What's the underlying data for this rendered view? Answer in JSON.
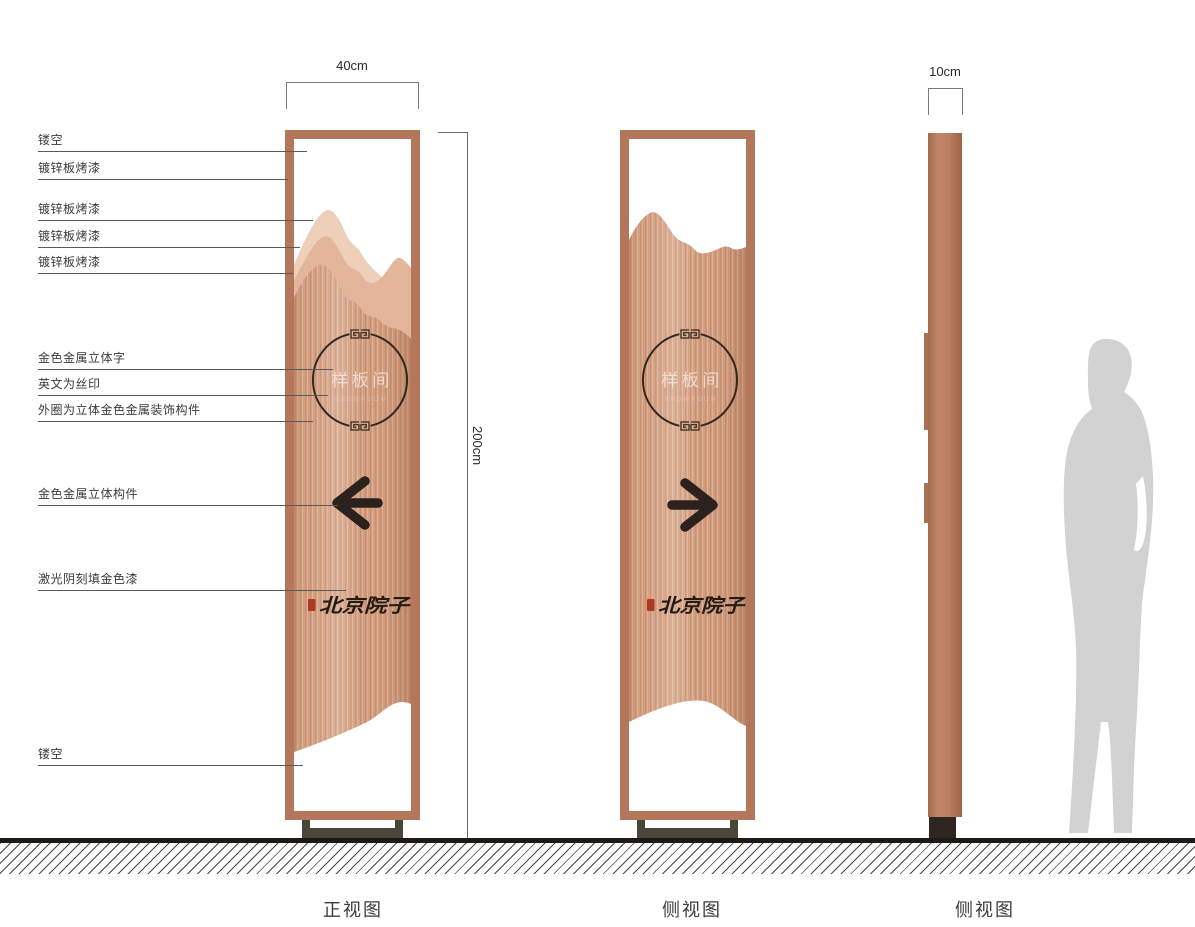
{
  "dimensions": {
    "front_width": "40cm",
    "height": "200cm",
    "side_thickness": "10cm"
  },
  "callouts": [
    {
      "id": "hollow-top",
      "label": "镂空"
    },
    {
      "id": "galvanized-frame",
      "label": "镀锌板烤漆"
    },
    {
      "id": "galvanized-layer-1",
      "label": "镀锌板烤漆"
    },
    {
      "id": "galvanized-layer-2",
      "label": "镀锌板烤漆"
    },
    {
      "id": "galvanized-layer-3",
      "label": "镀锌板烤漆"
    },
    {
      "id": "gold-metal-3d-text",
      "label": "金色金属立体字"
    },
    {
      "id": "english-silkscreen",
      "label": "英文为丝印"
    },
    {
      "id": "outer-ring-gold-ornament",
      "label": "外圈为立体金色金属装饰构件"
    },
    {
      "id": "gold-metal-3d-component",
      "label": "金色金属立体构件"
    },
    {
      "id": "laser-engraved-gold",
      "label": "激光阴刻填金色漆"
    },
    {
      "id": "hollow-bottom",
      "label": "镂空"
    }
  ],
  "sign_content": {
    "room_name": "样板间",
    "english_subtext": "SHOWROOM",
    "brand_name": "北京院子"
  },
  "views": [
    {
      "label": "正视图"
    },
    {
      "label": "侧视图"
    },
    {
      "label": "侧视图"
    }
  ],
  "colors": {
    "frame_copper": "#b5775c",
    "panel_copper": "#d49d7f",
    "mountain_light": "#eed0ba",
    "mountain_mid": "#e3b59a",
    "accent_dark": "#2b211d",
    "seal_red": "#ae3a26",
    "silhouette_gray": "#d2d2d2",
    "ground_black": "#1c1916"
  }
}
